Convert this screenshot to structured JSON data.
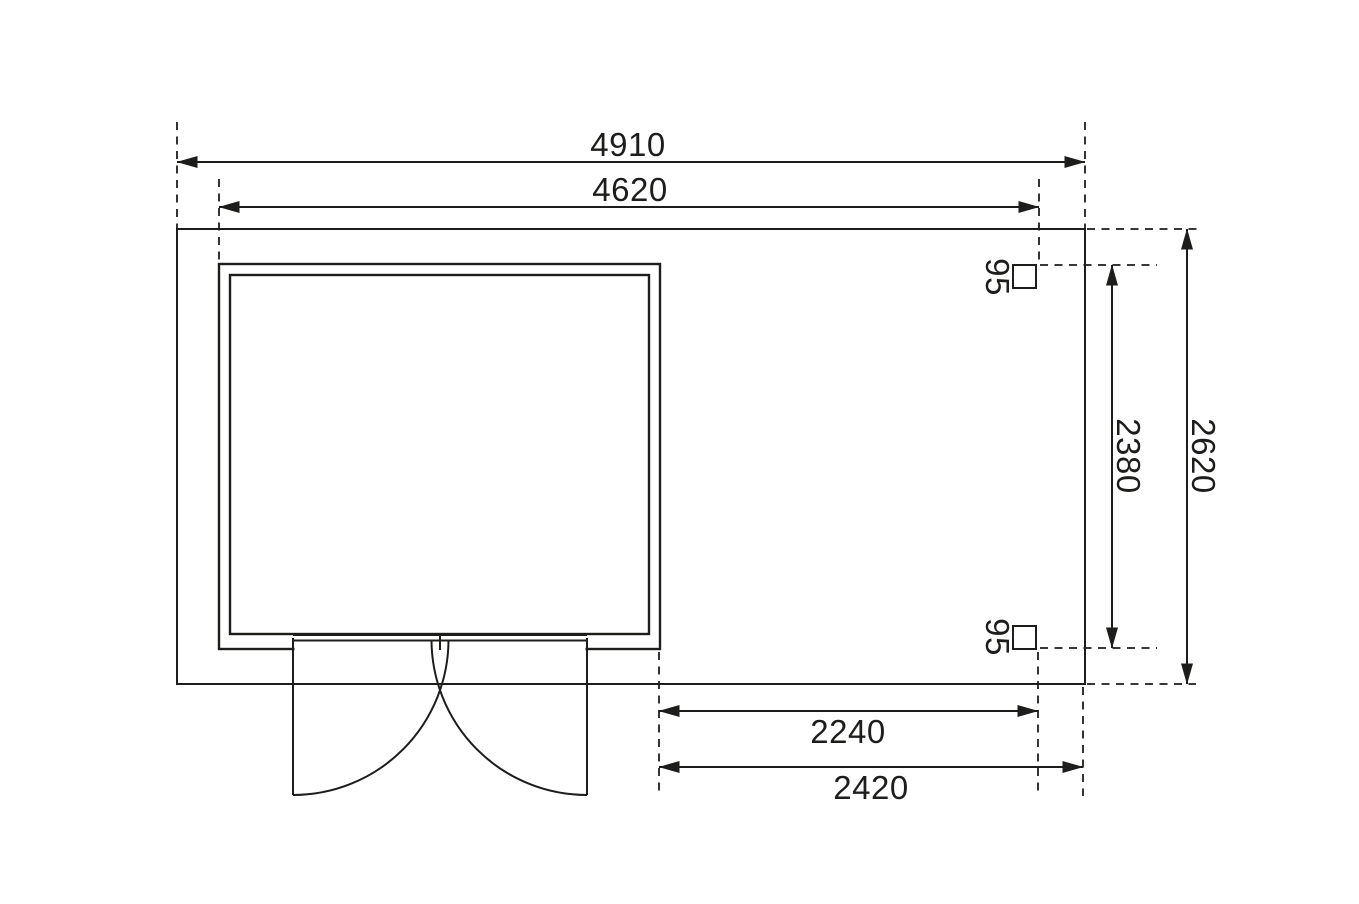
{
  "drawing": {
    "kind": "garden-shed-floor-plan",
    "colors": {
      "background": "#ffffff",
      "line": "#1d1d1b",
      "wall_fill": "#9c9ea1",
      "interior_fill": "#f4f4f5",
      "post_fill": "#b6b8ba"
    },
    "dimensions": {
      "overall_width": "4910",
      "shed_width": "4620",
      "overall_depth": "2620",
      "post_span_depth": "2380",
      "post_size_top": "95",
      "post_size_bottom": "95",
      "canopy_inner_width": "2240",
      "canopy_outer_width": "2420"
    }
  }
}
